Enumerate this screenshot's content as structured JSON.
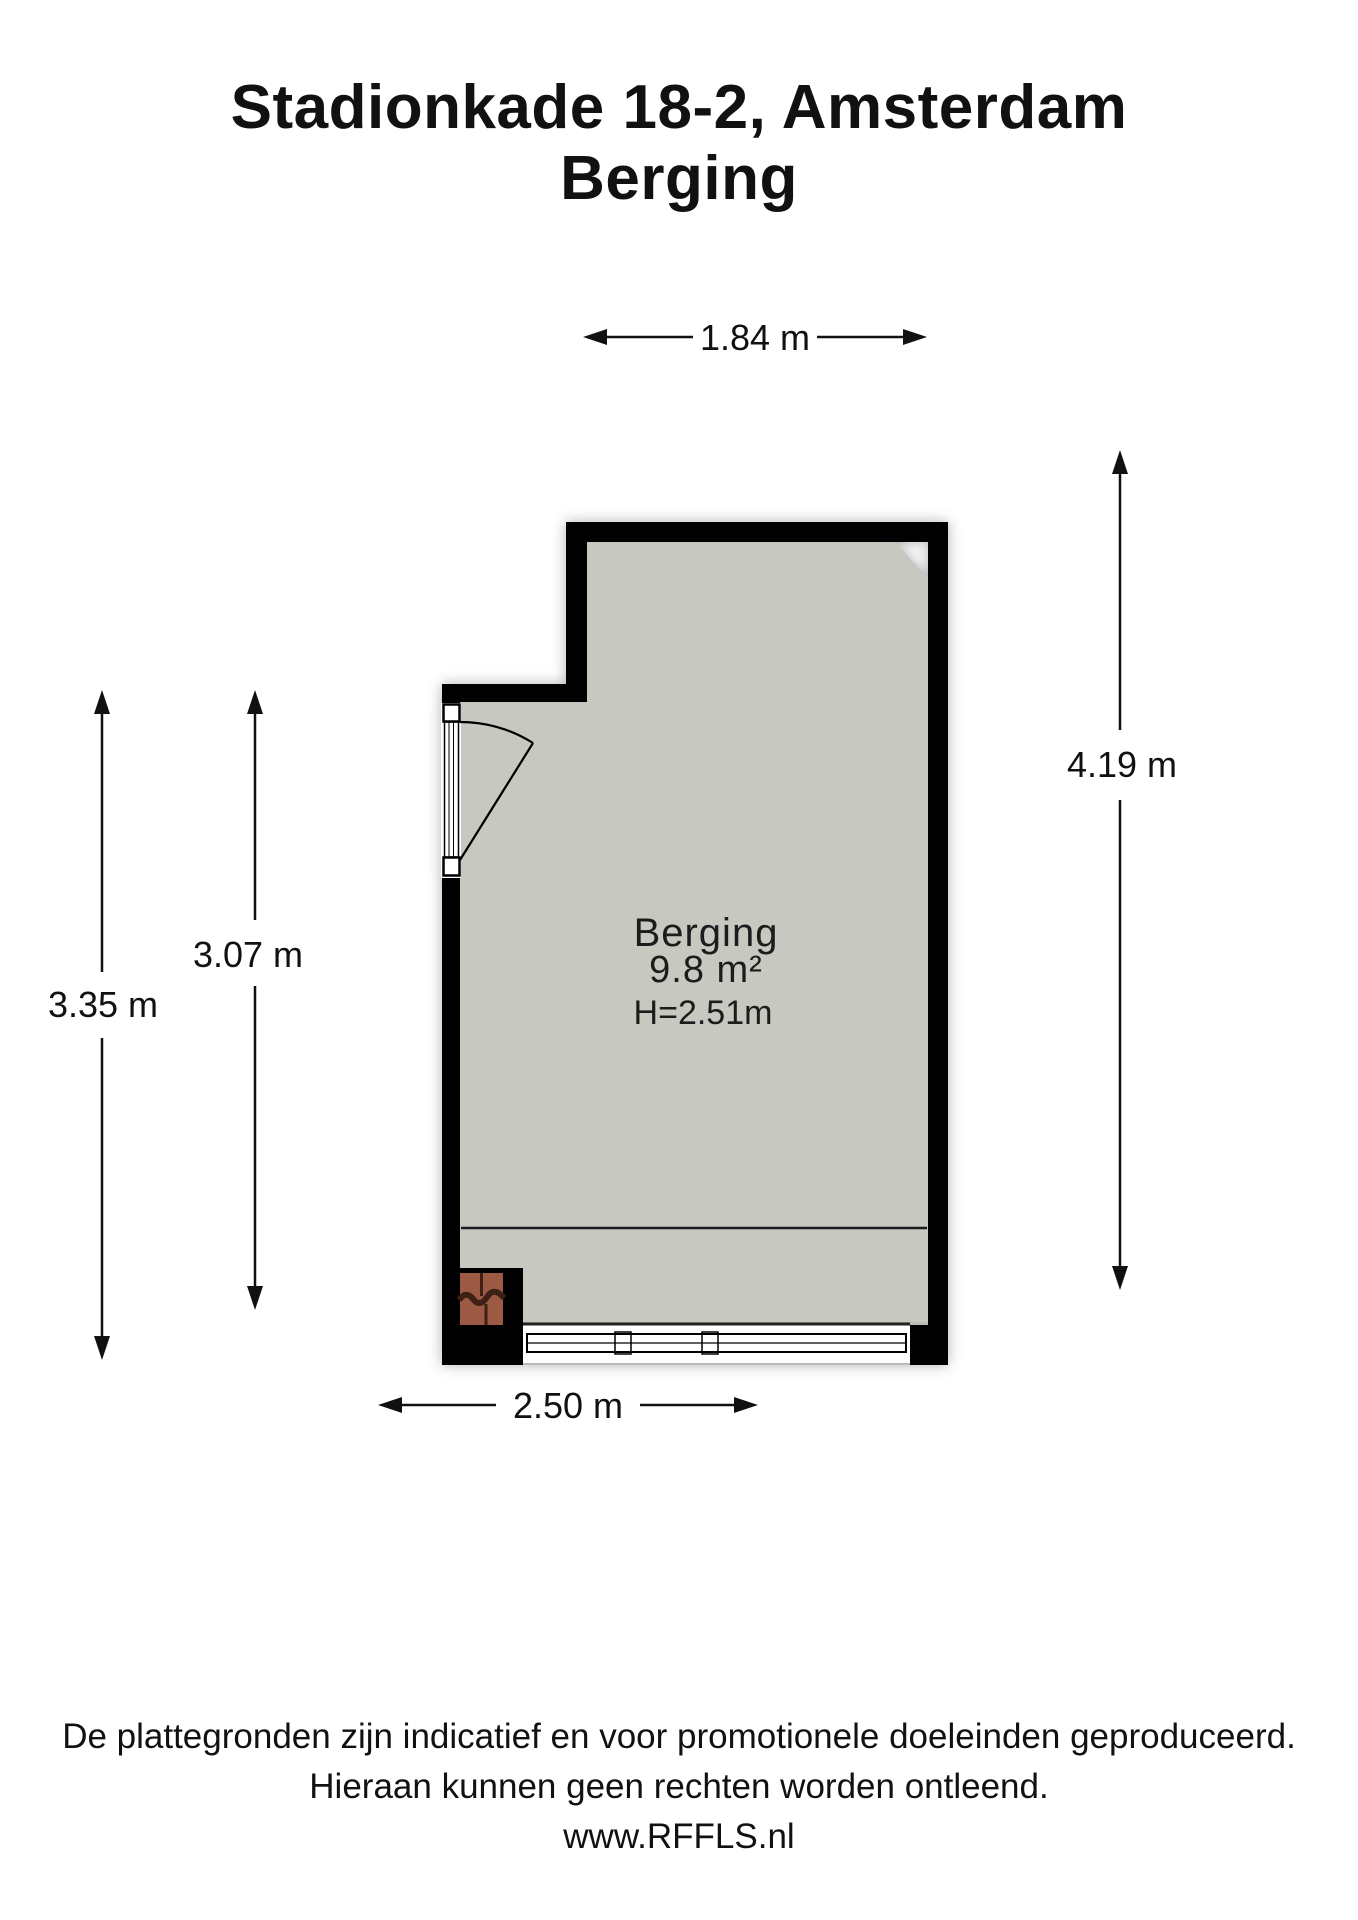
{
  "title": {
    "line1": "Stadionkade 18-2, Amsterdam",
    "line2": "Berging"
  },
  "room": {
    "name": "Berging",
    "area": "9.8 m²",
    "height": "H=2.51m"
  },
  "dimensions": {
    "top": "1.84 m",
    "left_outer": "3.35 m",
    "left_inner": "3.07 m",
    "right": "4.19 m",
    "bottom": "2.50 m"
  },
  "footer": {
    "line1": "De plattegronden zijn indicatief en voor promotionele doeleinden geproduceerd.",
    "line2": "Hieraan kunnen geen rechten worden ontleend.",
    "line3": "www.RFFLS.nl"
  },
  "colors": {
    "floor": "#c7c9c1",
    "wall": "#000000",
    "brick": "#9c5a44"
  }
}
